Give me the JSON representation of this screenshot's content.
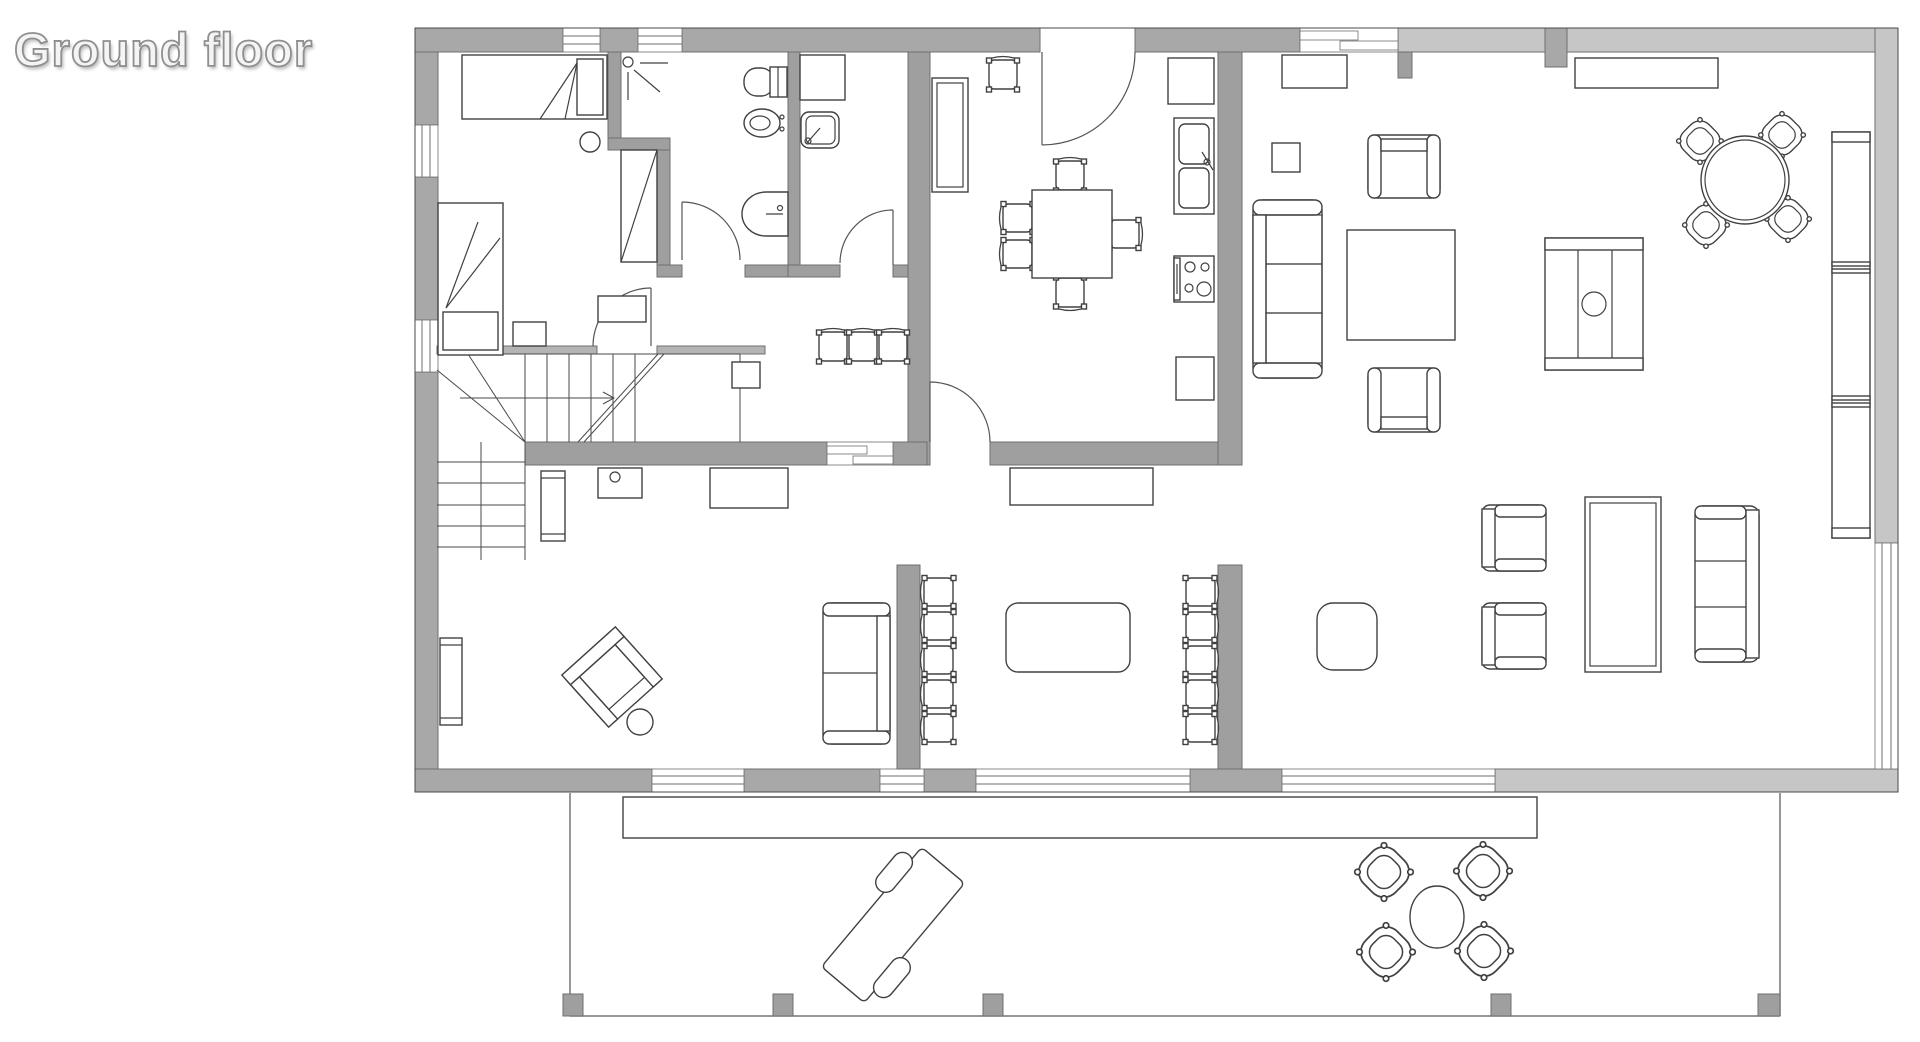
{
  "title": "Ground floor",
  "plan": {
    "floor_label": "Ground floor",
    "colors": {
      "wall_dark": "#a8a8a8",
      "wall_light": "#c6c6c6",
      "wall_interior": "#9f9f9f",
      "furniture_line": "#414141",
      "background": "#ffffff"
    },
    "rooms": [
      "bedroom",
      "bathroom",
      "wc",
      "kitchen-dining",
      "living-room",
      "hall-staircase",
      "study-room",
      "dining-room",
      "terrace"
    ],
    "furniture_inventory": {
      "bedroom": [
        "single-bed-top",
        "single-bed-left",
        "nightstand",
        "stool"
      ],
      "bathroom": [
        "shower-cabin",
        "shower-head",
        "toilet",
        "bidet",
        "washbasin"
      ],
      "wc": [
        "cabinet",
        "washbasin"
      ],
      "kitchen": [
        "tall-cabinet",
        "square-table",
        "chairs-x5",
        "fridge",
        "double-sink",
        "stove",
        "base-cabinet",
        "entry-door"
      ],
      "living_room": [
        "sideboard",
        "wall-shelf",
        "side-table",
        "armchair-x2",
        "sofa-3-seat",
        "coffee-table",
        "tv-cabinet",
        "round-table-with-4-chairs",
        "bookshelf",
        "sitting-group-armchairs-x2",
        "long-table",
        "sofa-3-seat-right",
        "bench"
      ],
      "hall": [
        "bench",
        "radiator",
        "chairs-x3",
        "cabinet",
        "lamp-table",
        "desk",
        "wall-cabinet",
        "rotated-armchair",
        "ottoman"
      ],
      "dining_room": [
        "sideboard",
        "sofa-2-seat",
        "chair-column-x5-left",
        "oval-table",
        "chair-column-x5-right"
      ],
      "terrace": [
        "deck-step",
        "sun-lounger",
        "round-table",
        "round-chairs-x4",
        "posts-x5"
      ]
    }
  }
}
